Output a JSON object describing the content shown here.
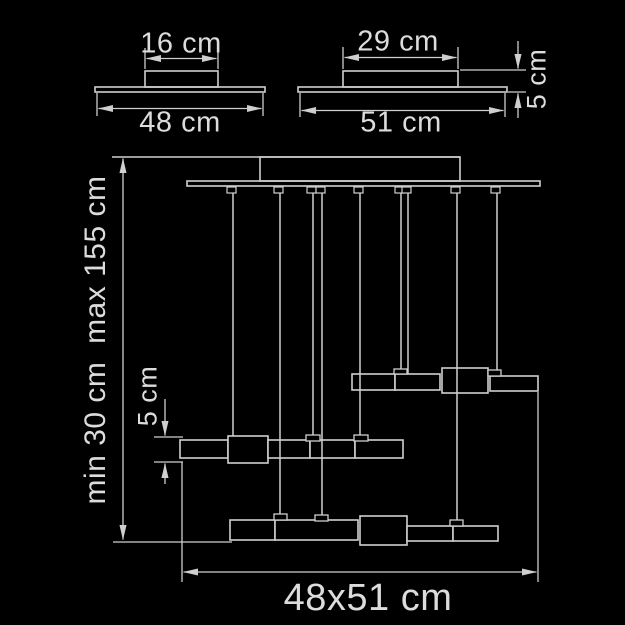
{
  "diagram_type": "pendant-lamp-dimension-drawing",
  "colors": {
    "background": "#000000",
    "line": "#cfcfcf",
    "text": "#dcdcdc"
  },
  "labels": {
    "small_view_top_width": "16 cm",
    "small_view_base_width": "48 cm",
    "large_view_top_width": "29 cm",
    "large_view_base_width": "51 cm",
    "large_view_height": "5 cm",
    "assembly_height_range": "min 30 cm  max 155 cm",
    "assembly_bar_height": "5 cm",
    "assembly_footprint": "48x51 cm"
  }
}
